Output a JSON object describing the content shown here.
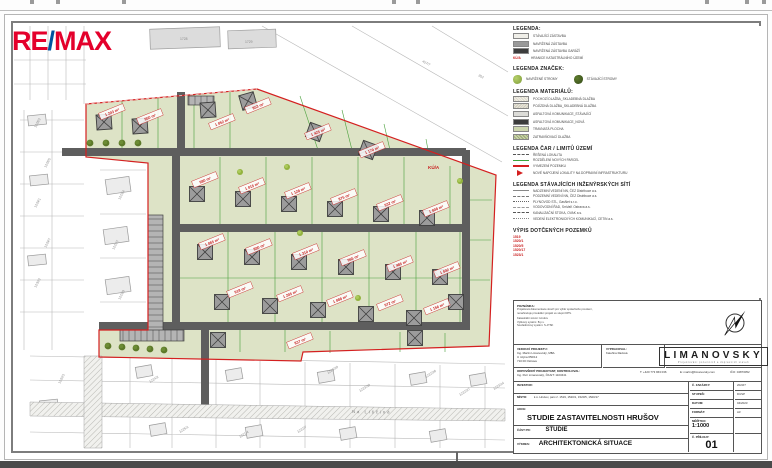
{
  "logo": {
    "re": "RE",
    "slash": "/",
    "max": "MAX"
  },
  "legend_main": {
    "title": "LEGENDA:",
    "items": [
      {
        "label": "STÁVAJÍCÍ ZÁSTAVBA"
      },
      {
        "label": "NAVRŽENÁ ZÁSTAVBA"
      },
      {
        "label": "NAVRŽENÁ ZÁSTAVBA GARÁŽÍ"
      },
      {
        "symbol": "KÚ/A",
        "label": "HRANICE KATASTRÁLNÍHO ÚZEMÍ"
      }
    ]
  },
  "legend_marks": {
    "title": "LEGENDA ZNAČEK:",
    "items": [
      {
        "label": "NAVRŽENÉ STROMY"
      },
      {
        "label": "STÁVAJÍCÍ STROMY"
      }
    ]
  },
  "legend_materials": {
    "title": "LEGENDA MATERIÁLŮ:",
    "items": [
      "POCHOZÍ DLAŽBA_SKLADEBNÁ DLAŽBA",
      "POJÍZDNÁ DLAŽBA_SKLADEBNÁ DLAŽBA",
      "ASFALTOVÁ KOMUNIKACE_STÁVAJÍCÍ",
      "ASFALTOVÁ KOMUNIKACE_NOVÁ",
      "TRAVNATÁ PLOCHA",
      "ZATRAVŇOVACÍ DLAŽBA"
    ]
  },
  "legend_lines": {
    "title": "LEGENDA ČAR / LIMITŮ ÚZEMÍ",
    "items": [
      "ŘEŠENÁ LOKALITA",
      "ROZDĚLENÍ NOVÝCH PARCEL",
      "VYMEZENÍ POZEMKU",
      "NOVÉ NAPOJENÍ LOKALITY NA DOPRAVNÍ INFRASTRUKTURU"
    ]
  },
  "legend_networks": {
    "title": "LEGENDA STÁVAJÍCÍCH INŽENÝRSKÝCH SÍTÍ",
    "items": [
      "NADZEMNÍ VEDENÍ NN, ČEZ Distribuce a.s.",
      "PODZEMNÍ VEDENÍ NN, ČEZ Distribuce a.s.",
      "PLYNOVOD STL, GasNet s.r.o.",
      "VODOVODNÍ ŘAD, SmVaK Ostrava a.s.",
      "KANALIZAČNÍ STOKA, OVAK a.s.",
      "VEDENÍ ELEKTRONICKÝCH KOMUNIKACÍ, CETIN a.s."
    ]
  },
  "affected": {
    "title": "VÝPIS DOTČENÝCH POZEMKŮ",
    "items": [
      "1519",
      "1520/1",
      "1520/5",
      "1520/17",
      "1523/1"
    ]
  },
  "map": {
    "street": "Na Liščině",
    "ku_note": "KÚ/A",
    "area_labels": [
      "1 243 m²",
      "950 m²",
      "1 052 m²",
      "853 m²",
      "1 425 m²",
      "1 170 m²",
      "980 m²",
      "1 015 m²",
      "1 128 m²",
      "875 m²",
      "932 m²",
      "1 008 m²",
      "1 065 m²",
      "890 m²",
      "1 310 m²",
      "965 m²",
      "1 485 m²",
      "1 042 m²",
      "918 m²",
      "1 205 m²",
      "1 088 m²",
      "972 m²",
      "1 156 m²",
      "837 m²"
    ],
    "cadastral_labels": [
      "1728",
      "1729",
      "457/7",
      "302",
      "1228/2",
      "1228/5",
      "1229/1",
      "1229/7",
      "1230/2",
      "1223/4",
      "1223/7",
      "1223/9",
      "1223/28",
      "1223/38",
      "1222/26",
      "1222/27",
      "1222/7",
      "1224/2",
      "1225/1",
      "1221/4",
      "1220/3",
      "1223/14"
    ]
  },
  "titleblock": {
    "note_title": "POZNÁMKA:",
    "note_lines": [
      "Projektová dokumentace slouží pro výběr společného povolení,",
      "nenahrazuje prováděcí projekt ve stupni DPS.",
      "Katastrální území: Hrušov",
      "Výškový systém: B.p.v.",
      "Souřadnicový systém: S-JTSK"
    ],
    "lead_label": "VEDOUCÍ PROJEKTU:",
    "lead_name": "Ing. Martin Limanovský, MBA",
    "lead_addr1": "U mlýna 650/12",
    "lead_addr2": "710 00 Ostrava",
    "made_label": "VYPRACOVAL:",
    "made_name": "Kateřina Radová",
    "firm": "LIMANOVSKY",
    "firm_sub": "Projektování pozemních a dopravních staveb",
    "resp_label": "ODPOVĚDNÝ PROJEKTANT, KONTROLOVAL:",
    "resp_name": "Ing. Petr Limanovský, ČKAIT: 1103441",
    "phone": "T: +420 773 963 036",
    "email": "E: martin@limanovsky.com",
    "ico": "IČO: 04873052",
    "investor_label": "INVESTOR:",
    "investor_value": "",
    "place_label": "MÍSTO:",
    "place_value": "k.ú. Hrušov, parc.č. 1519, 1520/1, 1520/5, 1520/17",
    "action_label": "AKCE:",
    "action_value": "STUDIE ZASTAVITELNOSTI HRUŠOV",
    "part_label": "ČÁST PD:",
    "part_value": "STUDIE",
    "drawing_label": "VÝKRES:",
    "drawing_value": "ARCHITEKTONICKÁ SITUACE",
    "order_label": "Č. ZAKÁZKY:",
    "order_value": "2023/7",
    "stage_label": "STUPEŇ:",
    "stage_value": "DUSP",
    "date_label": "DATUM:",
    "date_value": "04/2023",
    "format_label": "FORMÁT:",
    "format_value": "A3",
    "scale_label": "MĚŘÍTKO:",
    "scale_value": "1:1000",
    "attach_label": "Č. PŘÍLOHY:",
    "attach_value": "01"
  }
}
